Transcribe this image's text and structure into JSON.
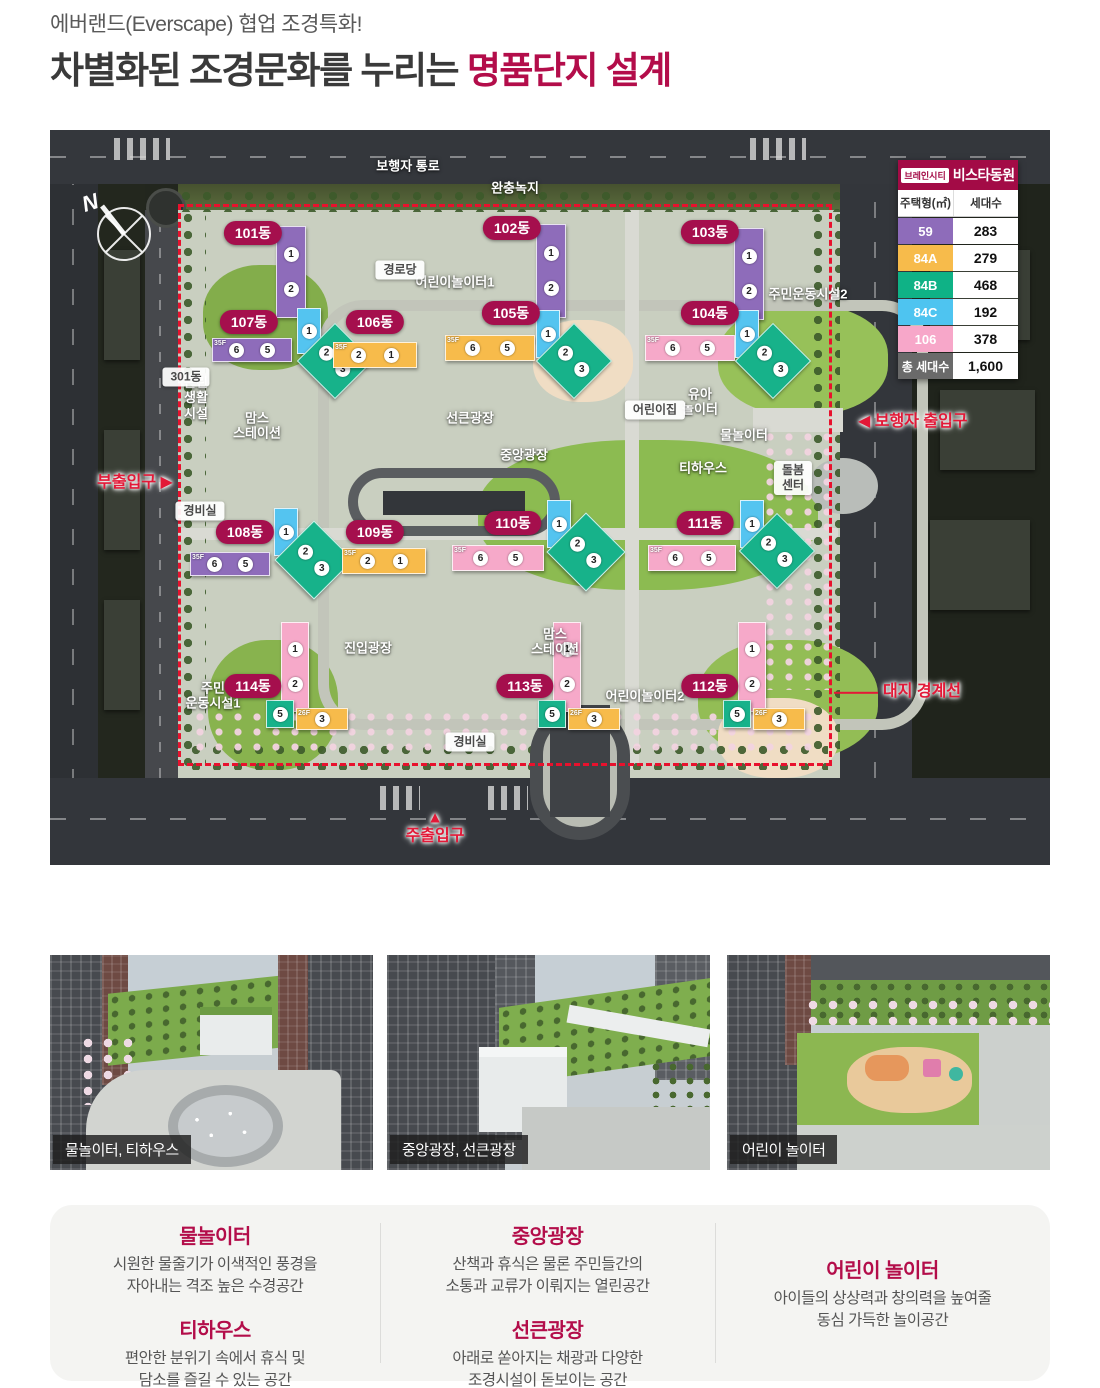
{
  "header": {
    "subtitle": "에버랜드(Everscape) 협업 조경특화!",
    "title_plain": "차별화된 조경문화를 누리는 ",
    "title_accent": "명품단지 설계"
  },
  "legend": {
    "brand_chip": "브레인시티",
    "brand_name": "비스타동원",
    "col_type": "주택형(㎡)",
    "col_count": "세대수",
    "rows": [
      {
        "type": "59",
        "count": "283",
        "color": "#8e6cba"
      },
      {
        "type": "84A",
        "count": "279",
        "color": "#f7bb4b"
      },
      {
        "type": "84B",
        "count": "468",
        "color": "#0fb286"
      },
      {
        "type": "84C",
        "count": "192",
        "color": "#4ec4f0"
      },
      {
        "type": "106",
        "count": "378",
        "color": "#f7a7c9"
      }
    ],
    "total_label": "총 세대수",
    "total_value": "1,600"
  },
  "map": {
    "compass": "N",
    "palette": {
      "59": "#8e6cba",
      "84A": "#f7bb4b",
      "84B": "#17b28a",
      "84C": "#54c4f0",
      "106": "#f6a9c9"
    },
    "buildings": [
      {
        "name": "101동",
        "lx": 203,
        "ly": 103,
        "blocks": [
          {
            "x": 226,
            "y": 96,
            "w": 30,
            "h": 92,
            "t": "59",
            "dir": "v",
            "n": [
              1,
              2
            ]
          }
        ]
      },
      {
        "name": "102동",
        "lx": 462,
        "ly": 98,
        "blocks": [
          {
            "x": 486,
            "y": 94,
            "w": 30,
            "h": 94,
            "t": "59",
            "dir": "v",
            "n": [
              1,
              2
            ]
          }
        ]
      },
      {
        "name": "103동",
        "lx": 660,
        "ly": 102,
        "blocks": [
          {
            "x": 684,
            "y": 98,
            "w": 30,
            "h": 92,
            "t": "59",
            "dir": "v",
            "n": [
              1,
              2
            ]
          }
        ]
      },
      {
        "name": "107동",
        "lx": 199,
        "ly": 192,
        "blocks": [
          {
            "x": 162,
            "y": 208,
            "w": 80,
            "h": 24,
            "t": "59",
            "n": [
              6,
              5
            ],
            "f": "35F"
          },
          {
            "x": 247,
            "y": 178,
            "w": 24,
            "h": 46,
            "t": "84C",
            "dir": "v",
            "n": [
              1
            ]
          },
          {
            "x": 258,
            "y": 204,
            "w": 54,
            "h": 54,
            "t": "84B",
            "rot": true,
            "n": [
              2,
              3
            ]
          }
        ]
      },
      {
        "name": "106동",
        "lx": 325,
        "ly": 192,
        "blocks": [
          {
            "x": 283,
            "y": 212,
            "w": 84,
            "h": 26,
            "t": "84A",
            "n": [
              2,
              1
            ],
            "f": "35F"
          }
        ]
      },
      {
        "name": "105동",
        "lx": 461,
        "ly": 183,
        "blocks": [
          {
            "x": 395,
            "y": 205,
            "w": 90,
            "h": 26,
            "t": "84A",
            "n": [
              6,
              5
            ],
            "f": "35F"
          },
          {
            "x": 486,
            "y": 180,
            "w": 24,
            "h": 48,
            "t": "84C",
            "dir": "v",
            "n": [
              1
            ]
          },
          {
            "x": 497,
            "y": 204,
            "w": 54,
            "h": 54,
            "t": "84B",
            "rot": true,
            "n": [
              2,
              3
            ]
          }
        ]
      },
      {
        "name": "104동",
        "lx": 660,
        "ly": 183,
        "blocks": [
          {
            "x": 595,
            "y": 205,
            "w": 90,
            "h": 26,
            "t": "106",
            "n": [
              6,
              5
            ],
            "f": "35F"
          },
          {
            "x": 685,
            "y": 180,
            "w": 24,
            "h": 48,
            "t": "84C",
            "dir": "v",
            "n": [
              1
            ]
          },
          {
            "x": 696,
            "y": 204,
            "w": 54,
            "h": 54,
            "t": "84B",
            "rot": true,
            "n": [
              2,
              3
            ]
          }
        ]
      },
      {
        "name": "108동",
        "lx": 195,
        "ly": 402,
        "blocks": [
          {
            "x": 140,
            "y": 422,
            "w": 80,
            "h": 24,
            "t": "59",
            "n": [
              6,
              5
            ],
            "f": "35F"
          },
          {
            "x": 224,
            "y": 378,
            "w": 24,
            "h": 48,
            "t": "84C",
            "dir": "v",
            "n": [
              1
            ]
          },
          {
            "x": 236,
            "y": 402,
            "w": 56,
            "h": 56,
            "t": "84B",
            "rot": true,
            "n": [
              2,
              3
            ]
          }
        ]
      },
      {
        "name": "109동",
        "lx": 325,
        "ly": 402,
        "blocks": [
          {
            "x": 292,
            "y": 418,
            "w": 84,
            "h": 26,
            "t": "84A",
            "n": [
              2,
              1
            ],
            "f": "35F"
          }
        ]
      },
      {
        "name": "110동",
        "lx": 463,
        "ly": 393,
        "blocks": [
          {
            "x": 402,
            "y": 415,
            "w": 92,
            "h": 26,
            "t": "106",
            "n": [
              6,
              5
            ],
            "f": "35F"
          },
          {
            "x": 497,
            "y": 370,
            "w": 24,
            "h": 48,
            "t": "84C",
            "dir": "v",
            "n": [
              1
            ]
          },
          {
            "x": 508,
            "y": 394,
            "w": 56,
            "h": 56,
            "t": "84B",
            "rot": true,
            "n": [
              2,
              3
            ]
          }
        ]
      },
      {
        "name": "111동",
        "lx": 655,
        "ly": 393,
        "blocks": [
          {
            "x": 598,
            "y": 415,
            "w": 88,
            "h": 26,
            "t": "106",
            "n": [
              6,
              5
            ],
            "f": "35F"
          },
          {
            "x": 690,
            "y": 370,
            "w": 24,
            "h": 48,
            "t": "84C",
            "dir": "v",
            "n": [
              1
            ]
          },
          {
            "x": 700,
            "y": 394,
            "w": 54,
            "h": 54,
            "t": "84B",
            "rot": true,
            "n": [
              2,
              3
            ]
          }
        ]
      },
      {
        "name": "114동",
        "lx": 203,
        "ly": 556,
        "blocks": [
          {
            "x": 231,
            "y": 492,
            "w": 28,
            "h": 90,
            "t": "106",
            "dir": "v",
            "n": [
              1,
              2
            ]
          },
          {
            "x": 216,
            "y": 570,
            "w": 28,
            "h": 28,
            "t": "84B",
            "n": [
              5
            ]
          },
          {
            "x": 246,
            "y": 578,
            "w": 52,
            "h": 22,
            "t": "84A",
            "n": [
              3
            ],
            "f": "26F"
          }
        ]
      },
      {
        "name": "113동",
        "lx": 475,
        "ly": 556,
        "blocks": [
          {
            "x": 503,
            "y": 492,
            "w": 28,
            "h": 90,
            "t": "106",
            "dir": "v",
            "n": [
              1,
              2
            ]
          },
          {
            "x": 488,
            "y": 570,
            "w": 28,
            "h": 28,
            "t": "84B",
            "n": [
              5
            ]
          },
          {
            "x": 518,
            "y": 578,
            "w": 52,
            "h": 22,
            "t": "84A",
            "n": [
              3
            ],
            "f": "26F"
          }
        ]
      },
      {
        "name": "112동",
        "lx": 660,
        "ly": 556,
        "blocks": [
          {
            "x": 688,
            "y": 492,
            "w": 28,
            "h": 90,
            "t": "106",
            "dir": "v",
            "n": [
              1,
              2
            ]
          },
          {
            "x": 673,
            "y": 570,
            "w": 28,
            "h": 28,
            "t": "84B",
            "n": [
              5
            ]
          },
          {
            "x": 703,
            "y": 578,
            "w": 52,
            "h": 22,
            "t": "84A",
            "n": [
              3
            ],
            "f": "26F"
          }
        ]
      }
    ],
    "area_labels": [
      {
        "t": "보행자 통로",
        "x": 358,
        "y": 36
      },
      {
        "t": "완충녹지",
        "x": 465,
        "y": 58
      },
      {
        "t": "어린이놀이터1",
        "x": 405,
        "y": 152
      },
      {
        "t": "주민운동시설2",
        "x": 758,
        "y": 164
      },
      {
        "t": "유아\n놀이터",
        "x": 650,
        "y": 272
      },
      {
        "t": "물놀이터",
        "x": 694,
        "y": 305
      },
      {
        "t": "티하우스",
        "x": 653,
        "y": 338
      },
      {
        "t": "선큰광장",
        "x": 420,
        "y": 288
      },
      {
        "t": "중앙광장",
        "x": 474,
        "y": 325
      },
      {
        "t": "맘스\n스테이션",
        "x": 207,
        "y": 296
      },
      {
        "t": "근린\n생활\n시설",
        "x": 146,
        "y": 268
      },
      {
        "t": "진입광장",
        "x": 318,
        "y": 518
      },
      {
        "t": "맘스\n스테이션",
        "x": 505,
        "y": 512
      },
      {
        "t": "주민\n운동시설1",
        "x": 163,
        "y": 566
      },
      {
        "t": "어린이놀이터2",
        "x": 595,
        "y": 566
      }
    ],
    "box_labels": [
      {
        "t": "경로당",
        "x": 350,
        "y": 140
      },
      {
        "t": "301동",
        "x": 136,
        "y": 247
      },
      {
        "t": "어린이집",
        "x": 605,
        "y": 280
      },
      {
        "t": "돌봄\n센터",
        "x": 743,
        "y": 348
      },
      {
        "t": "경비실",
        "x": 150,
        "y": 381
      },
      {
        "t": "경비실",
        "x": 420,
        "y": 612
      }
    ],
    "red_labels": [
      {
        "t": "◀ 보행자 출입구",
        "x": 808,
        "y": 292,
        "a": "l"
      },
      {
        "t": "부출입구 ▶",
        "x": 85,
        "y": 353
      },
      {
        "t": "대지 경계선",
        "x": 872,
        "y": 562,
        "line": true
      },
      {
        "t": "▲\n주출입구",
        "x": 385,
        "y": 698
      }
    ]
  },
  "photos": [
    {
      "caption": "물놀이터, 티하우스"
    },
    {
      "caption": "중앙광장, 선큰광장"
    },
    {
      "caption": "어린이 놀이터"
    }
  ],
  "features": {
    "col1": [
      {
        "title": "물놀이터",
        "desc": "시원한 물줄기가 이색적인 풍경을\n자아내는 격조 높은 수경공간"
      },
      {
        "title": "티하우스",
        "desc": "편안한 분위기 속에서 휴식 및\n담소를 즐길 수 있는 공간"
      }
    ],
    "col2": [
      {
        "title": "중앙광장",
        "desc": "산책과 휴식은 물론 주민들간의\n소통과 교류가 이뤄지는 열린공간"
      },
      {
        "title": "선큰광장",
        "desc": "아래로 쏟아지는 채광과 다양한\n조경시설이 돋보이는 공간"
      }
    ],
    "col3": [
      {
        "title": "어린이 놀이터",
        "desc": "아이들의 상상력과 창의력을 높여줄\n동심 가득한 놀이공간"
      }
    ]
  }
}
